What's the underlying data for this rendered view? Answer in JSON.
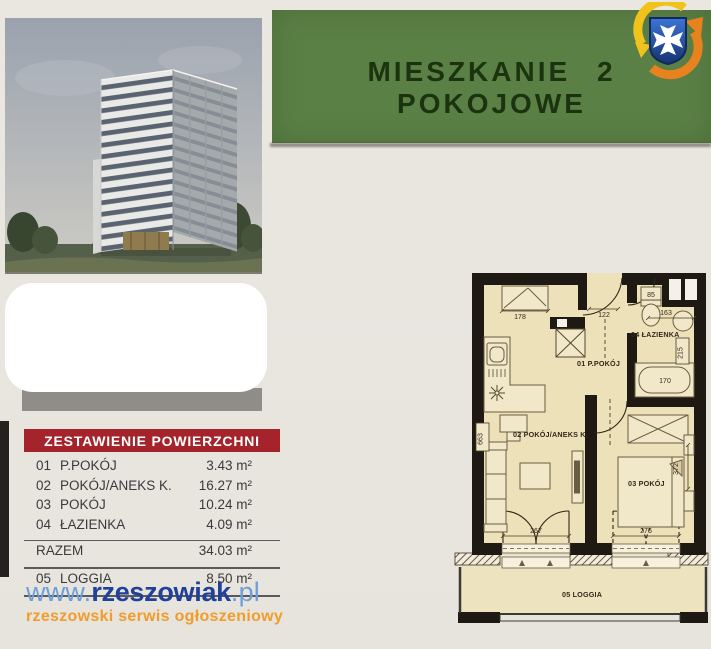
{
  "banner": {
    "title": "MIESZKANIE 2 POKOJOWE"
  },
  "logo": {
    "icon": "rzeszow-crest-with-circular-arrows"
  },
  "area_table": {
    "header": "ZESTAWIENIE POWIERZCHNI",
    "rows": [
      {
        "no": "01",
        "name": "P.POKÓJ",
        "area": "3.43 m²"
      },
      {
        "no": "02",
        "name": "POKÓJ/ANEKS K.",
        "area": "16.27 m²"
      },
      {
        "no": "03",
        "name": "POKÓJ",
        "area": "10.24 m²"
      },
      {
        "no": "04",
        "name": "ŁAZIENKA",
        "area": "4.09 m²"
      }
    ],
    "total_label": "RAZEM",
    "total_area": "34.03 m²",
    "loggia_no": "05",
    "loggia_name": "LOGGIA",
    "loggia_area": "8.50 m²"
  },
  "footer": {
    "www": "www.",
    "brand": "rzeszowiak",
    "tld": ".pl",
    "tagline": "rzeszowski serwis ogłoszeniowy"
  },
  "floorplan": {
    "room_labels": {
      "hall": "01 P.POKÓJ",
      "living": "02 POKÓJ/ANEKS K.",
      "bedroom": "03 POKÓJ",
      "bath": "04 ŁAZIENKA",
      "loggia": "05 LOGGIA"
    },
    "dims": {
      "closet": "178",
      "hall": "122",
      "shaft": "85",
      "bath_width": "163",
      "bath_depth": "215",
      "tub": "170",
      "kitchen": "663",
      "bedroom_depth": "372",
      "living_door": "267",
      "bedroom_door": "275"
    }
  },
  "colors": {
    "banner_green": "#5b8046",
    "table_header_red": "#a5232b",
    "brand_blue": "#21409a",
    "brand_lightblue": "#6f9fd8",
    "tagline_orange": "#f19c2b",
    "plan_beige": "#ece1b8"
  }
}
